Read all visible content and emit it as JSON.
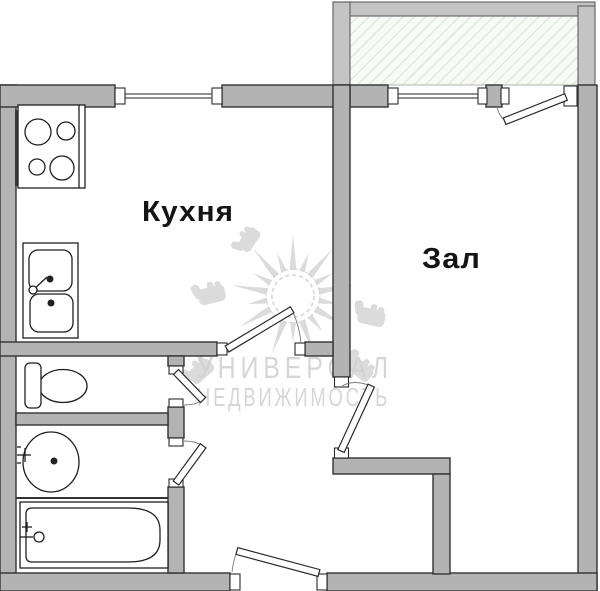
{
  "plan": {
    "rooms": {
      "kitchen": {
        "label": "Кухня"
      },
      "living": {
        "label": "Зал"
      }
    },
    "watermark": {
      "line1": "УНИВЕРСАЛ",
      "line2": "НЕДВИЖИМОСТЬ"
    },
    "fixtures": [
      "stove-icon",
      "kitchen-sink-icon",
      "toilet-icon",
      "washbasin-icon",
      "bathtub-icon",
      "window-icon",
      "door-swing-icon",
      "sun-logo-icon",
      "thumbs-up-icon"
    ],
    "colors": {
      "wall": "#b3b3b3",
      "balcony_wall": "#c4c4c4",
      "outline": "#333333",
      "hatch_bg": "#f8faf5",
      "hatch_line": "#e1eadd",
      "watermark": "#d0d0d0"
    }
  }
}
